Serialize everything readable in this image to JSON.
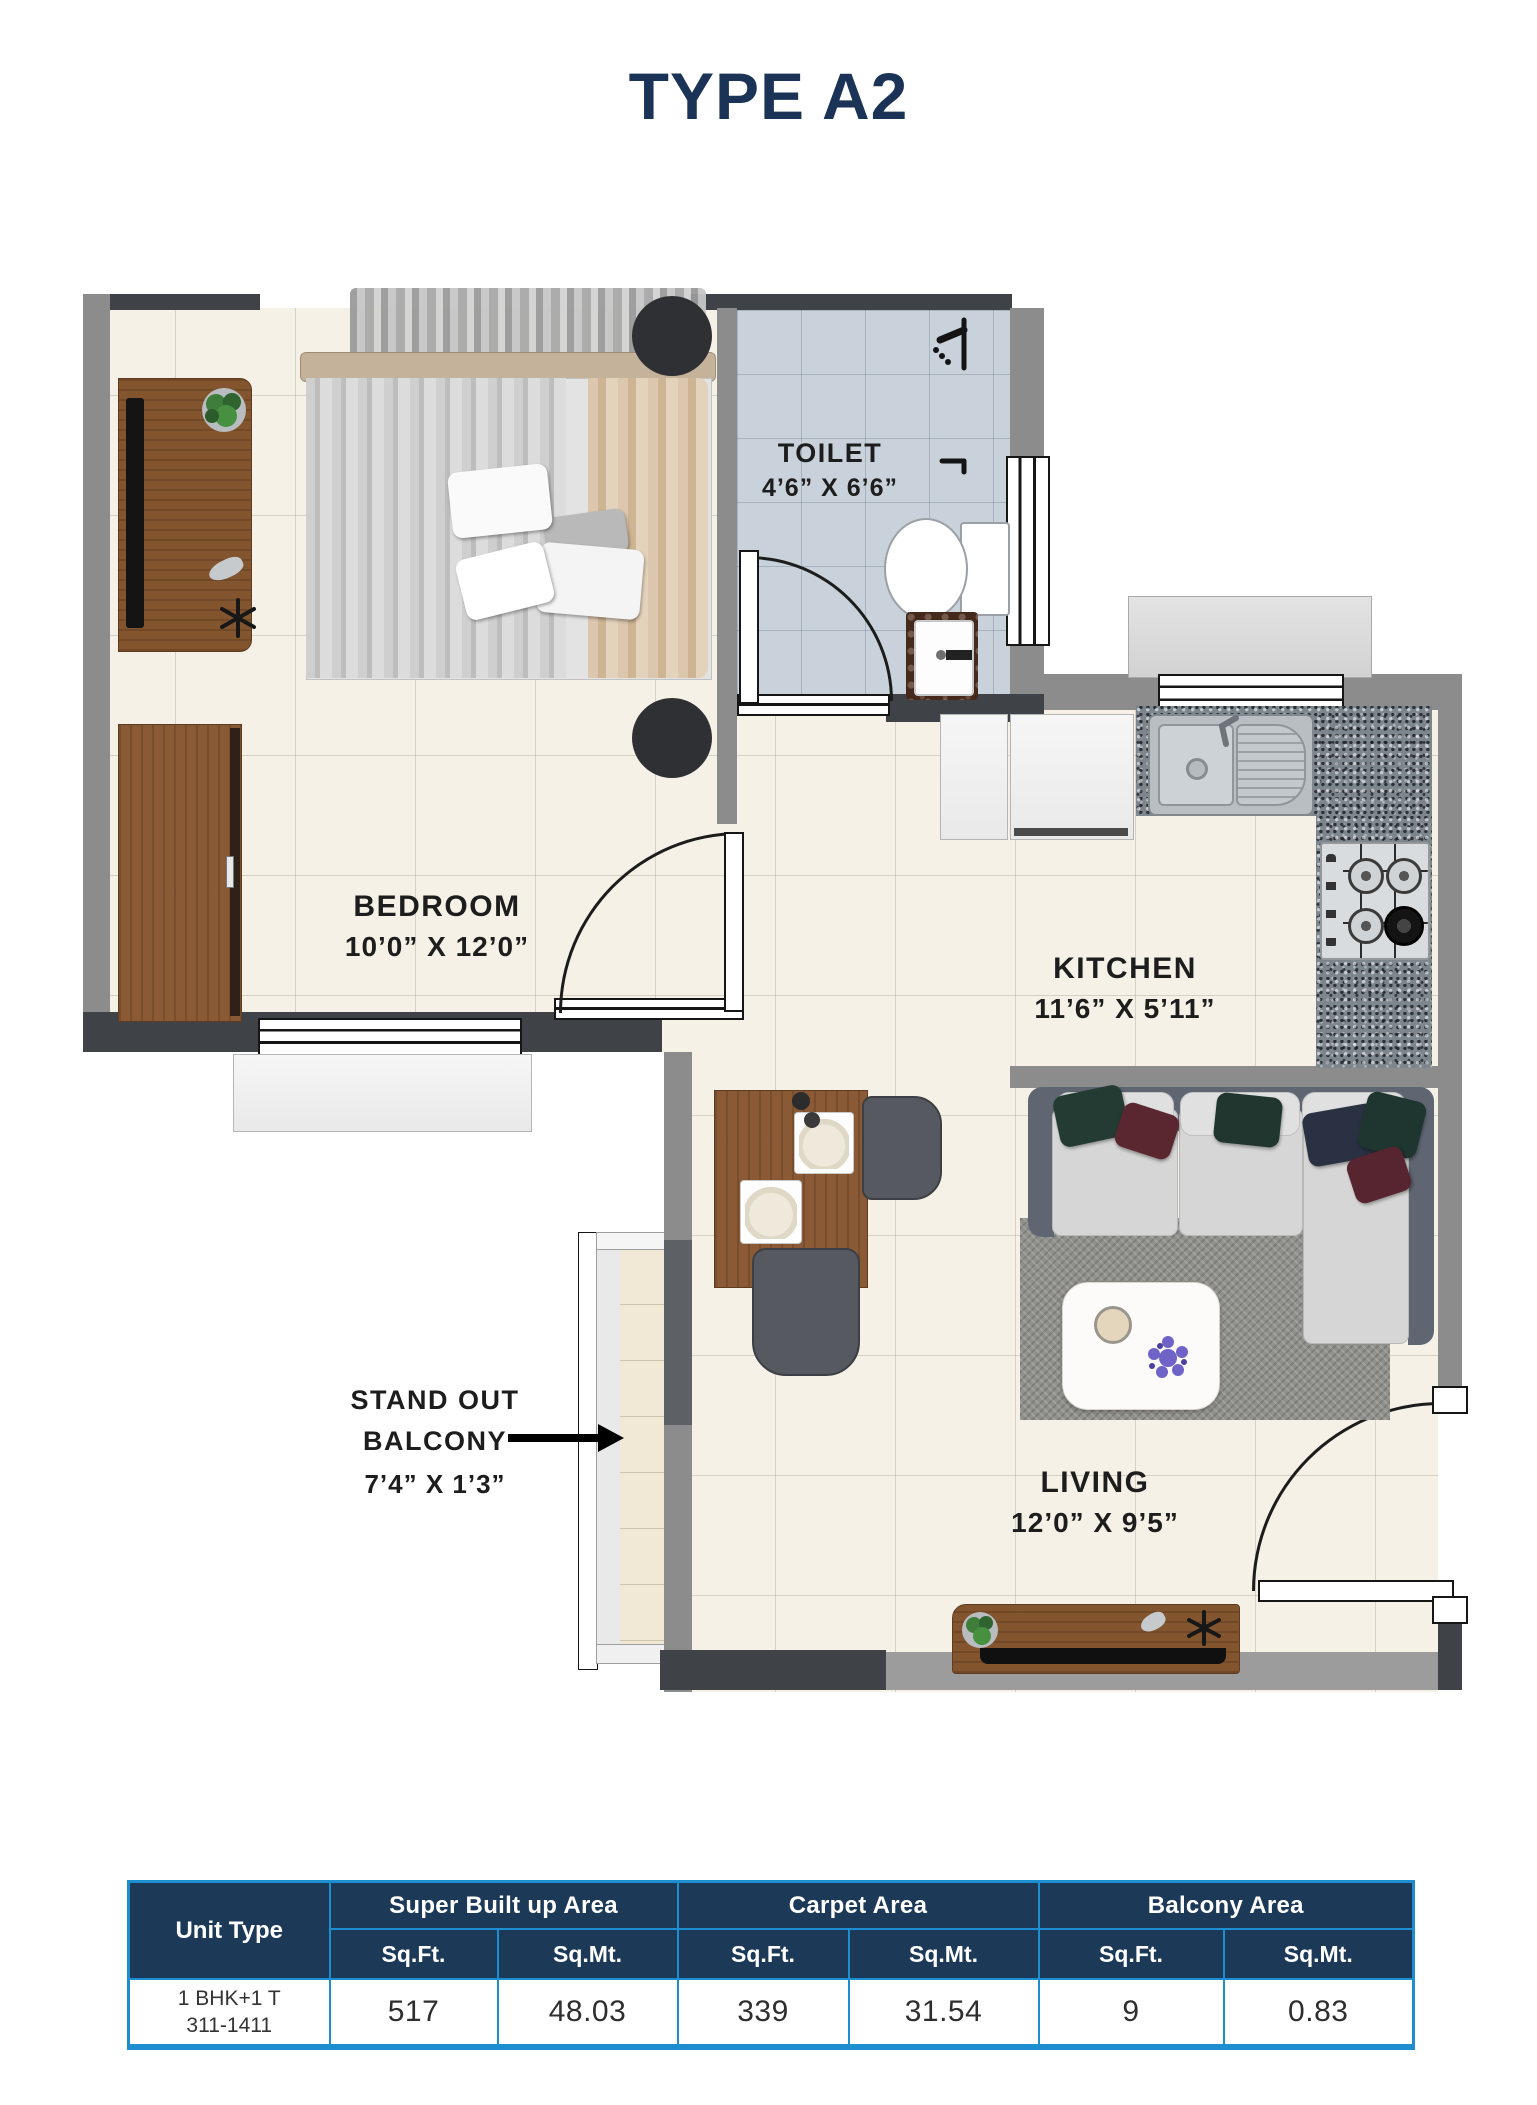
{
  "title": "TYPE A2",
  "plan": {
    "rooms": {
      "bedroom": {
        "name": "BEDROOM",
        "dims": "10’0” X 12’0”"
      },
      "toilet": {
        "name": "TOILET",
        "dims": "4’6” X 6’6”"
      },
      "kitchen": {
        "name": "KITCHEN",
        "dims": "11’6” X 5’11”"
      },
      "living": {
        "name": "LIVING",
        "dims": "12’0” X 9’5”"
      },
      "balcony": {
        "name": "STAND OUT BALCONY",
        "dims": "7’4” X 1’3”"
      }
    }
  },
  "table": {
    "unit_type_header": "Unit Type",
    "groups": [
      {
        "label": "Super Built up Area",
        "sub": [
          "Sq.Ft.",
          "Sq.Mt."
        ],
        "values": [
          "517",
          "48.03"
        ]
      },
      {
        "label": "Carpet Area",
        "sub": [
          "Sq.Ft.",
          "Sq.Mt."
        ],
        "values": [
          "339",
          "31.54"
        ]
      },
      {
        "label": "Balcony Area",
        "sub": [
          "Sq.Ft.",
          "Sq.Mt."
        ],
        "values": [
          "9",
          "0.83"
        ]
      }
    ],
    "unit": {
      "line1": "1 BHK+1 T",
      "line2": "311-1411"
    }
  },
  "colors": {
    "accent_navy": "#1a3357",
    "table_border_blue": "#1d8fd1",
    "table_header_bg": "#1c3a57",
    "wall_gray": "#8c8c8c",
    "wall_dark": "#3f4347",
    "floor_cream": "#f5f1e6",
    "toilet_tile_blue": "#c9d2da"
  }
}
